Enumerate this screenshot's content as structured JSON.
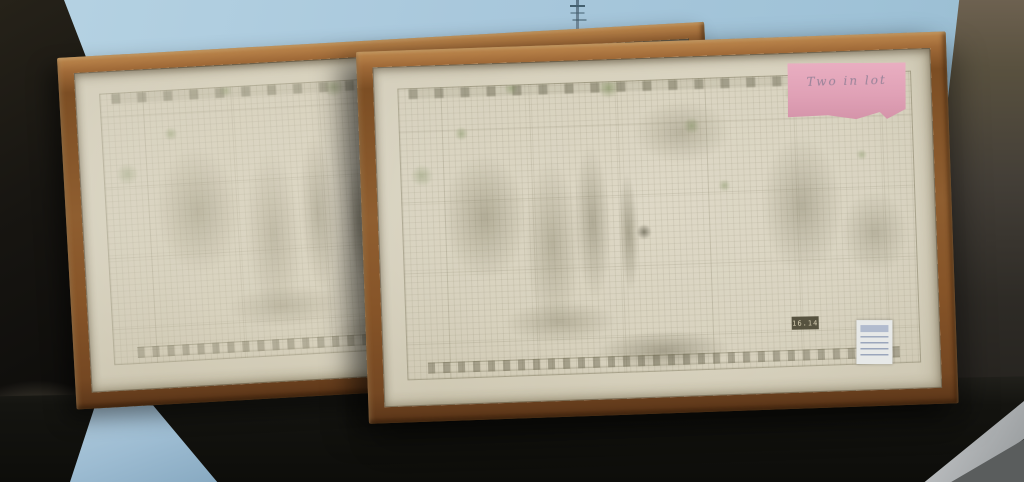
{
  "scene": {
    "description": "Photograph: two wood-framed architectural pencil drawings leaning side by side on a dark table against a light blue wall",
    "colors": {
      "wall": "#a7c6da",
      "frame_wood": "#8a5a2e",
      "paper": "#d7d1bd",
      "drawing_ink": "#6b6748",
      "drawing_green_accent": "#6e8246",
      "table": "#14130f",
      "left_shadow": "#151310",
      "right_wall": "#4a443c",
      "blue_strip": "#a3c1d6",
      "gray_strip": "#b3b6b8",
      "sticky_note": "#e0a1b6",
      "sticker": "#e7e9e8"
    }
  },
  "front_frame": {
    "sticky_note_text": "Two in lot",
    "plate_number": "16.14"
  }
}
